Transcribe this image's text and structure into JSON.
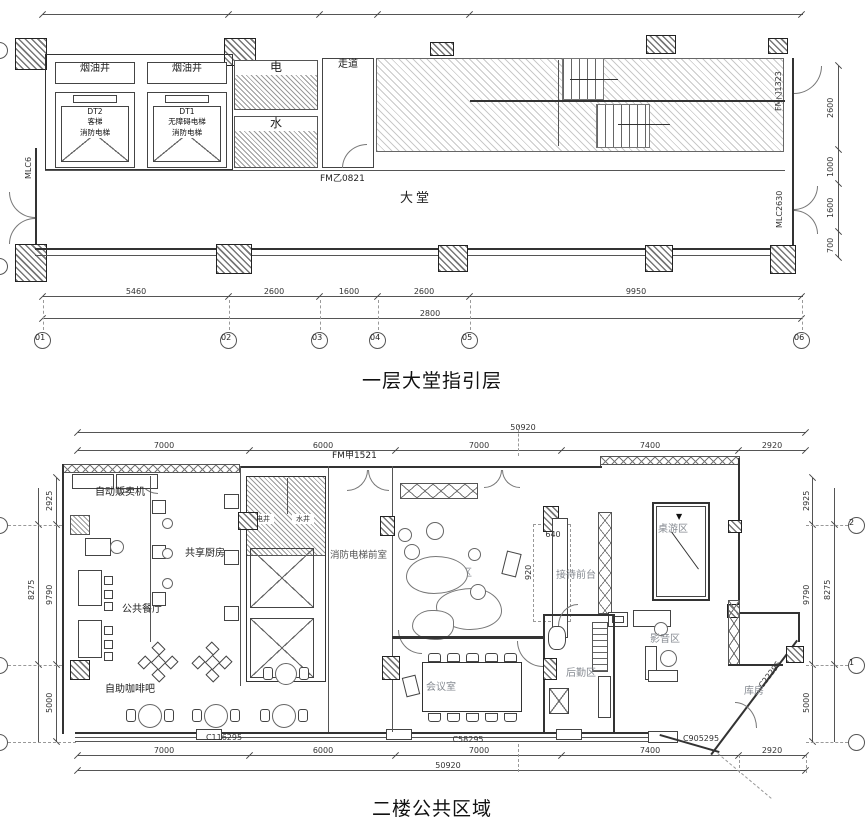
{
  "floor1": {
    "title": "一层大堂指引层",
    "rooms": {
      "smoke_shaft_1": "烟油井",
      "smoke_shaft_2": "烟油井",
      "lift2_name": "DT2",
      "lift2_line2": "客梯",
      "lift2_line3": "消防电梯",
      "lift1_name": "DT1",
      "lift1_line2": "无障碍电梯",
      "lift1_line3": "消防电梯",
      "electrical": "电",
      "water": "水",
      "corridor": "走道",
      "lobby": "大堂"
    },
    "codes": {
      "door_fm_0821": "FM乙0821",
      "door_fm_1323": "FM乙1323",
      "door_mlc2630": "MLC2630",
      "door_mlc6": "MLC6"
    },
    "grid_bubbles": [
      "01",
      "02",
      "03",
      "04",
      "05",
      "06"
    ],
    "dims_bottom": [
      "5460",
      "2600",
      "1600",
      "2600",
      "9950"
    ],
    "dims_bottom_total": "2800",
    "dims_right": [
      "2600",
      "1000",
      "1600",
      "700"
    ]
  },
  "floor2": {
    "title": "二楼公共区域",
    "rooms": {
      "vending": "自动贩卖机",
      "shared_kitchen": "共享厨房",
      "public_dining": "公共餐厅",
      "coffee_bar": "自助咖啡吧",
      "elec_shaft": "电井",
      "water_shaft": "水井",
      "fire_lift_lobby": "消防电梯前室",
      "reception": "接待区",
      "reception_desk": "接待前台",
      "game_area": "桌游区",
      "av_area": "影音区",
      "logistics": "后勤区",
      "meeting_room": "会议室",
      "storage": "库房"
    },
    "codes": {
      "door_fm_1521": "FM甲1521",
      "window_c116295": "C116295",
      "window_c58295": "C58295",
      "window_c905295": "C905295",
      "window_c22295": "C22295"
    },
    "grid_bubbles_left": [
      "2",
      "1",
      ""
    ],
    "grid_bubbles_right": [
      "2",
      "1",
      ""
    ],
    "dims_top": [
      "7000",
      "6000",
      "7000",
      "7400",
      "2920"
    ],
    "dims_top_total": "50920",
    "dims_bottom": [
      "7000",
      "6000",
      "7000",
      "7400",
      "2920"
    ],
    "dims_bottom_total": "50920",
    "dims_left": [
      "2925",
      "9790",
      "5000"
    ],
    "dims_left_total": "8275",
    "dims_right": [
      "2925",
      "9790",
      "5000"
    ],
    "dims_right_total": "8275",
    "interior_dims": {
      "desk_width": "640",
      "desk_depth": "920"
    }
  }
}
